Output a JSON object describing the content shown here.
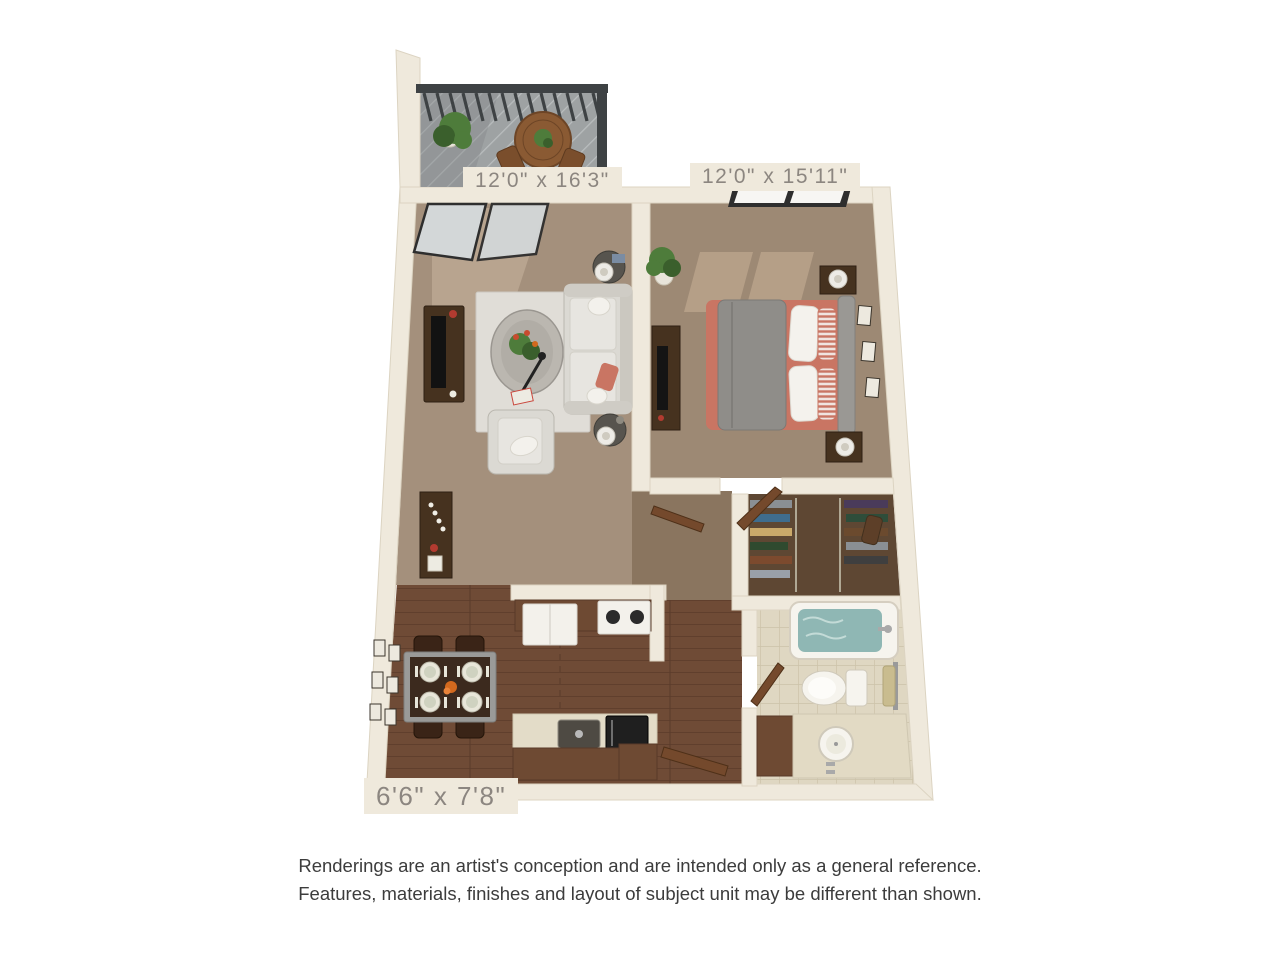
{
  "plan": {
    "rooms": [
      {
        "id": "living-room",
        "dimensions": "12'0\" x 16'3\""
      },
      {
        "id": "bedroom",
        "dimensions": "12'0\" x 15'11\""
      },
      {
        "id": "kitchen-dining",
        "dimensions": "6'6\" x 7'8\""
      }
    ]
  },
  "disclaimer": {
    "line1": "Renderings are an artist's conception and are intended only as a general reference.",
    "line2": "Features, materials, finishes and layout of subject unit may be different than shown."
  },
  "colors": {
    "wall": "#EFE9DC",
    "wall_edge": "#DCD4C2",
    "carpet_living": "#A4907C",
    "carpet_bedroom": "#9D8974",
    "carpet_hall": "#8A755F",
    "wood": "#6F4B36",
    "wood_dark": "#5A3B2A",
    "closet_floor": "#5E4733",
    "tile": "#DFD7C2",
    "tile_line": "#CCC2A9",
    "rug": "#E0DDD7",
    "sofa": "#DBD9D3",
    "coral": "#C97563",
    "blanket": "#8F8D89",
    "water": "#8FB7B4",
    "deck": "#9EA2A3",
    "railing": "#3E4244",
    "wood_furniture": "#46321F",
    "appliance": "#F3F1EB",
    "plant": "#4E7C3B",
    "plant_dark": "#3A5F2C",
    "glass": "#D3D7D8",
    "label_text": "#8C8680",
    "disclaimer_text": "#3C3C3C"
  }
}
